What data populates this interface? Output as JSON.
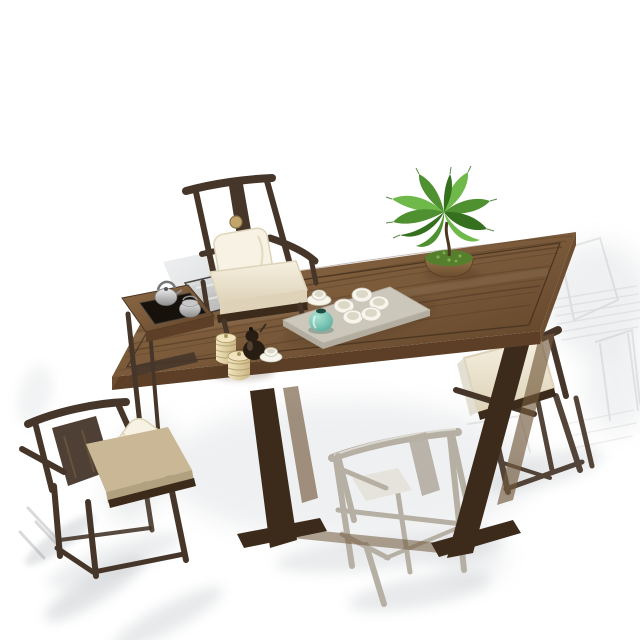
{
  "scene": {
    "type": "product-photo",
    "subject": "Chinese-style solid wood tea table set: long walnut plank table with stone tea tray, kettle side table, potted fern, and four Ming-style armchairs on a white studio background with gray ink-wash shadow strokes",
    "background": "#ffffff",
    "palette": {
      "background": "#ffffff",
      "table_wood_light": "#8a6843",
      "table_wood": "#7a5a3a",
      "table_wood_dark": "#5c3f26",
      "grain": "#4a3320",
      "groove": "#46311f",
      "leg_dark": "#3c2b1b",
      "leg_light": "#71593c",
      "chair_dark": "#46362a",
      "chair_gray": "#b5afa4",
      "chair_gray_light": "#e6e3dc",
      "cushion_cream_1": "#f6f0e0",
      "cushion_cream_2": "#ded3b9",
      "cushion_tan": "#c9b795",
      "cushion_tan_dark": "#b2a17f",
      "pillow_cream": "#f7f2e3",
      "tray_stone": "#ccc7bb",
      "tray_edge": "#b2ad9f",
      "tray_black": "#17110b",
      "porcelain": "#f7f5ec",
      "porcelain_shadow": "#dcd8c8",
      "silver_1": "#ececec",
      "silver_2": "#8f8f8f",
      "teal_1": "#a8e4d6",
      "teal_2": "#4da795",
      "canister_1": "#f0e3bd",
      "canister_2": "#cbb685",
      "canister_rib": "#a8935f",
      "teapot_dark": "#281d12",
      "plant_green": "#4f9030",
      "plant_green_light": "#6fb84a",
      "plant_green_dark": "#35701f",
      "moss_green": "#567f2d",
      "pot_1": "#96744c",
      "pot_2": "#6a4c2c",
      "shadow_wash": "#c3c7ca",
      "shadow_soft": "#e2e4e6",
      "sketch_gray": "#8a8d90",
      "panel_1": "#b7bcbe",
      "panel_2": "#dfe3e4"
    },
    "objects": [
      {
        "name": "tea-table",
        "description": "Long walnut plank tea table with perimeter groove and slab trestle legs"
      },
      {
        "name": "host-chair",
        "description": "Ming-style armchair with round medallion splat, white seat cushion and lumbar pillow"
      },
      {
        "name": "side-kettle-table",
        "description": "Low attached side table with recessed black tray, silver kettle and pot"
      },
      {
        "name": "glass-insert-panel",
        "description": "Gray glass/stone insert panel beside the host chair"
      },
      {
        "name": "guest-chair-left",
        "description": "Dark wood armchair seen from behind with tan cushion and draped white pillow"
      },
      {
        "name": "guest-chair-front",
        "description": "Pale gray washed-out wooden armchair seen from behind"
      },
      {
        "name": "guest-chair-right",
        "description": "Dark wood armchair with cream cushion seen from behind"
      },
      {
        "name": "tea-tray",
        "description": "Gray stone tea tray with five white tea cups"
      },
      {
        "name": "glass-teapot",
        "description": "Teal glass teapot with dark lid"
      },
      {
        "name": "cup-and-saucer-tray",
        "description": "White cup on saucer beside the tray"
      },
      {
        "name": "tea-canisters",
        "description": "Two ribbed cream tea canisters"
      },
      {
        "name": "dark-teapot",
        "description": "Small dark gourd-shaped clay teapot"
      },
      {
        "name": "cup-and-saucer-left",
        "description": "White cup on saucer near the canisters"
      },
      {
        "name": "fern-plant",
        "description": "Potted fern with moss in a shallow bronze bowl"
      },
      {
        "name": "ink-wash-shadows",
        "description": "Gray watercolor shadow strokes on the floor"
      },
      {
        "name": "ghost-sketch-chairs",
        "description": "Faint sketched chair outlines fading out on the right"
      }
    ]
  }
}
